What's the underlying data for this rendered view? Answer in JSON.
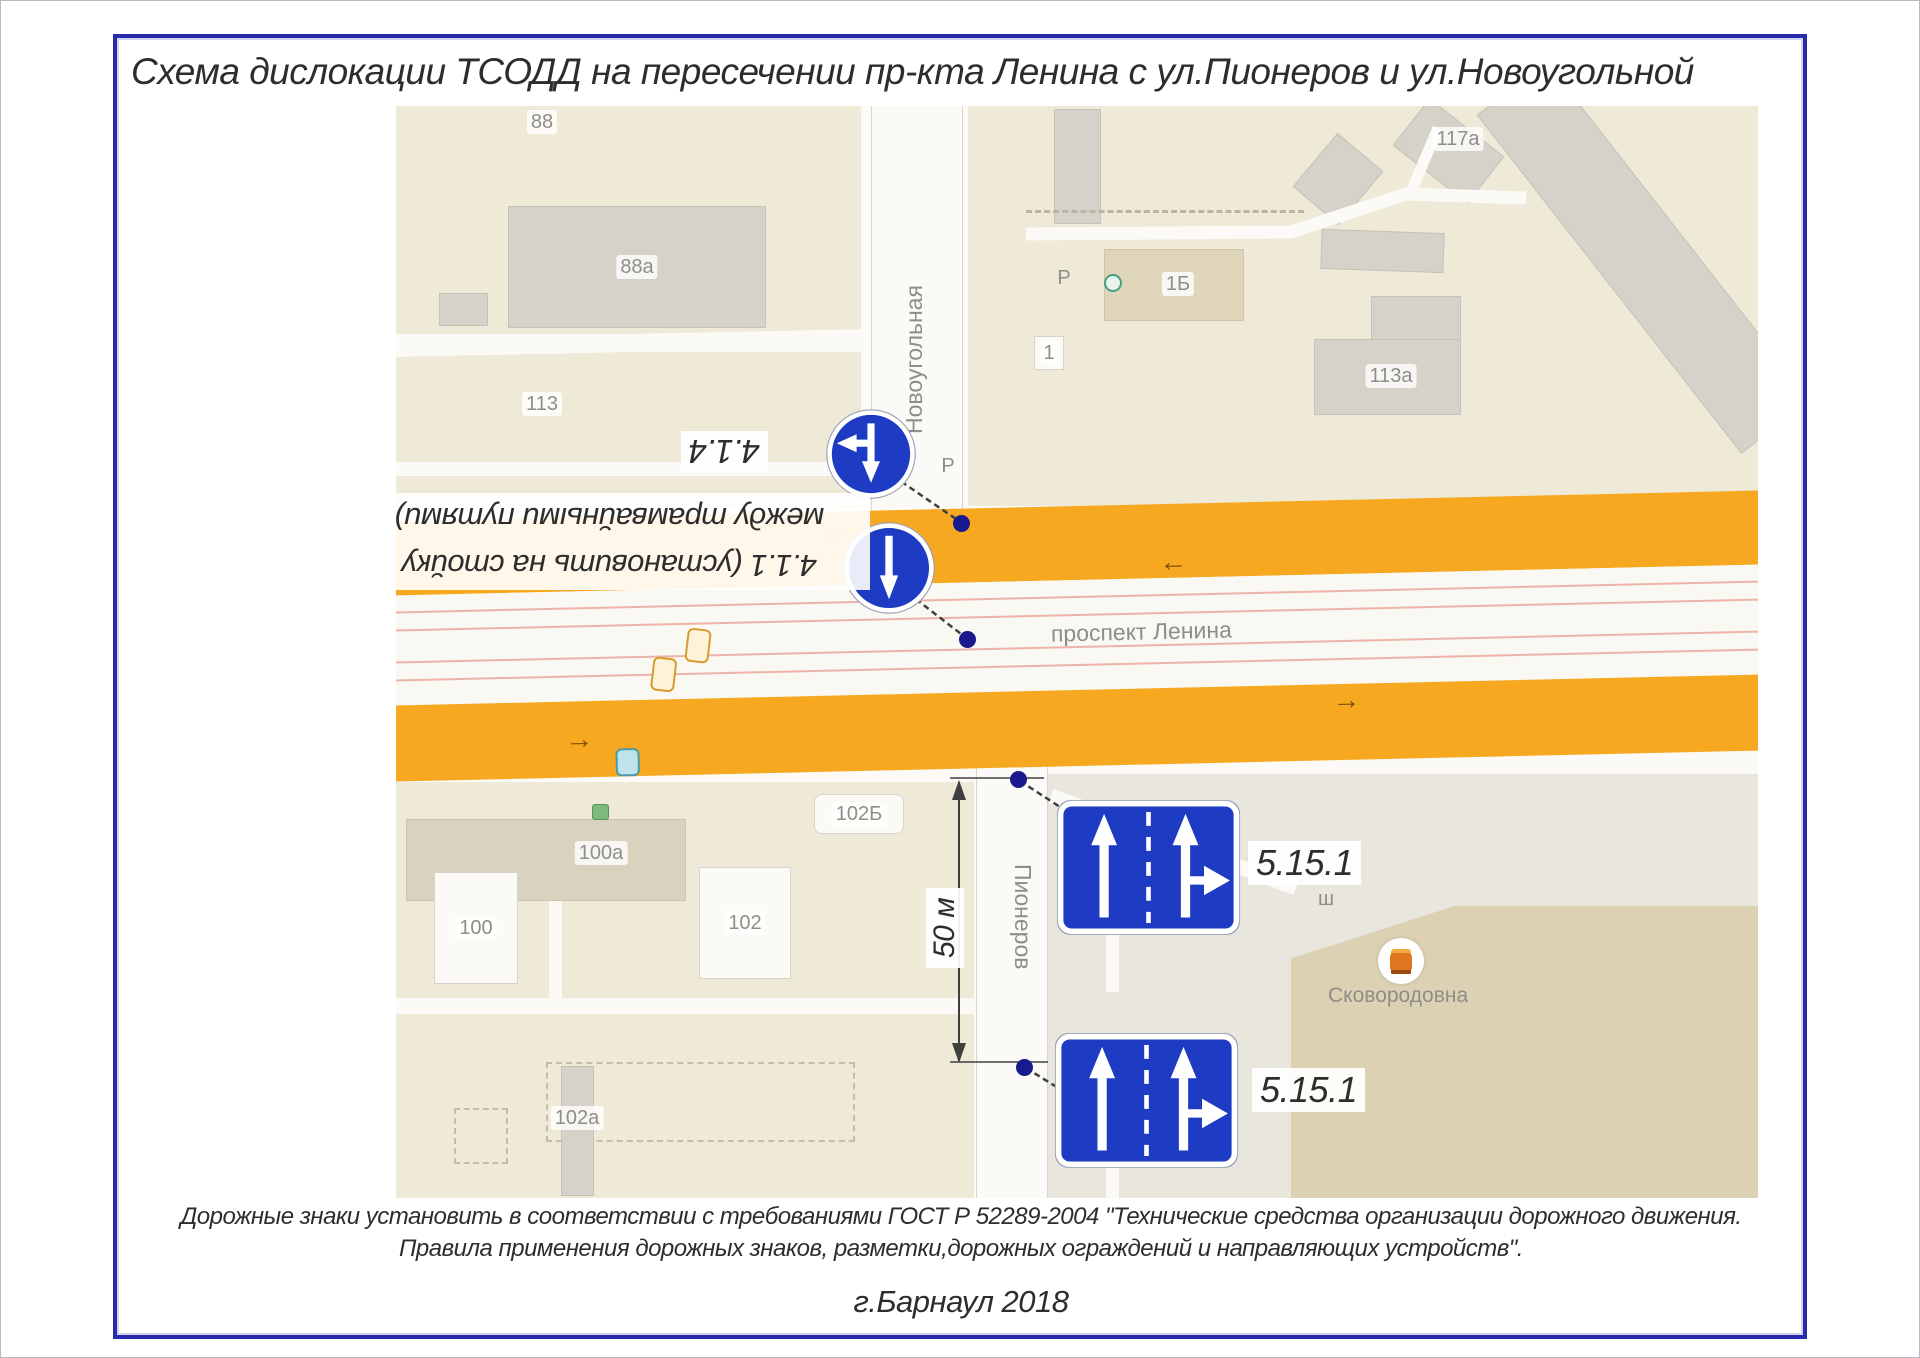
{
  "title": "Схема дислокации ТСОДД на пересечении пр-кта Ленина с ул.Пионеров и ул.Новоугольной",
  "footer": {
    "note_line1": "Дорожные знаки установить в соответствии с требованиями ГОСТ Р 52289-2004 \"Технические средства организации дорожного движения.",
    "note_line2": "Правила применения дорожных знаков, разметки,дорожных ограждений и направляющих устройств\".",
    "city_year": "г.Барнаул 2018"
  },
  "annotations": {
    "sign414_code": "4.1.4",
    "sign411_line1": "4.1.1 (установить на стойку",
    "sign411_line2": "между трамвайными путями)",
    "sign5151_code_top": "5.15.1",
    "sign5151_code_bottom": "5.15.1",
    "dimension_label": "50 м"
  },
  "map": {
    "street_top": "Новоугольная",
    "street_bottom": "Пионеров",
    "avenue": "проспект Ленина",
    "poi_label": "Сковородовна",
    "parking_letter": "Р",
    "misc_letter": "ш",
    "buildings": {
      "b88": "88",
      "b88a": "88а",
      "b113": "113",
      "b117a": "117а",
      "b1b": "1Б",
      "b1": "1",
      "b113a": "113а",
      "b102b": "102Б",
      "b100a": "100а",
      "b100": "100",
      "b102": "102",
      "b102a": "102а"
    }
  },
  "icons": {
    "arrow_left": "←",
    "arrow_right": "→"
  },
  "colors": {
    "road_orange": "#F7A821",
    "sign_blue": "#1E3BC3",
    "frame_blue": "#2929AC",
    "dot_navy": "#1A1A8E",
    "tram_pink": "#EDB3A9"
  }
}
